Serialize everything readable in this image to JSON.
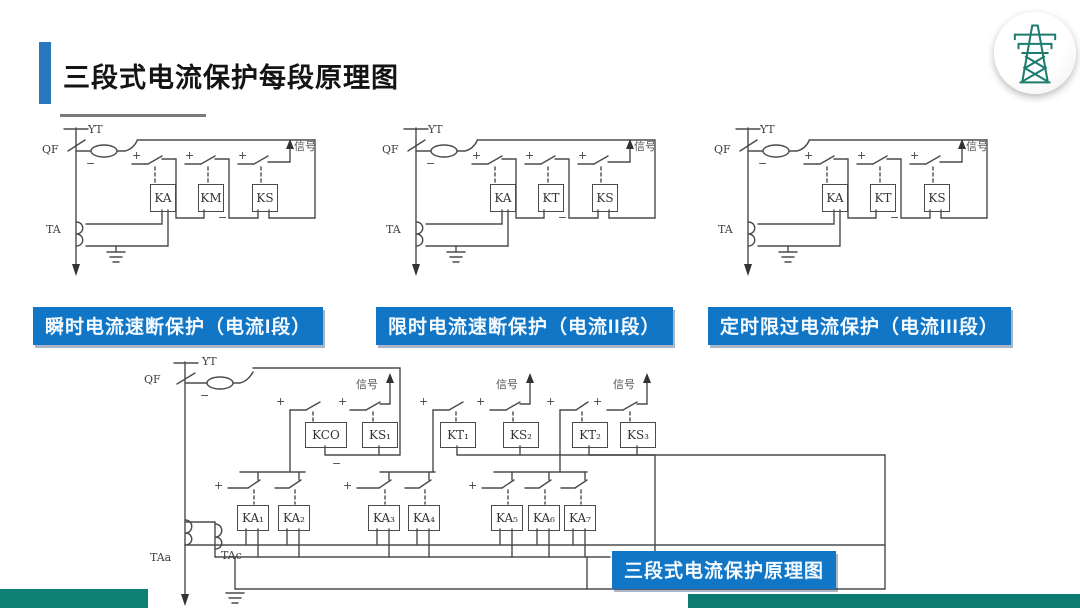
{
  "slide_title": "三段式电流保护每段原理图",
  "stage_diagrams": [
    {
      "caption": "瞬时电流速断保护（电流I段）",
      "labels": {
        "qf": "QF",
        "yt": "YT",
        "ta": "TA",
        "signal": "信号"
      },
      "relays": [
        "KA",
        "KM",
        "KS"
      ]
    },
    {
      "caption": "限时电流速断保护（电流II段）",
      "labels": {
        "qf": "QF",
        "yt": "YT",
        "ta": "TA",
        "signal": "信号"
      },
      "relays": [
        "KA",
        "KT",
        "KS"
      ]
    },
    {
      "caption": "定时限过电流保护（电流III段）",
      "labels": {
        "qf": "QF",
        "yt": "YT",
        "ta": "TA",
        "signal": "信号"
      },
      "relays": [
        "KA",
        "KT",
        "KS"
      ]
    }
  ],
  "combined_diagram": {
    "caption": "三段式电流保护原理图",
    "labels": {
      "qf": "QF",
      "yt": "YT",
      "taa": "TAa",
      "tac": "TAc",
      "signal": "信号"
    },
    "row1_relays": [
      "KCO",
      "KS₁",
      "KT₁",
      "KS₂",
      "KT₂",
      "KS₃"
    ],
    "row2_relays": [
      "KA₁",
      "KA₂",
      "KA₃",
      "KA₄",
      "KA₅",
      "KA₆",
      "KA₇"
    ]
  },
  "symbols": {
    "plus": "+",
    "minus": "−"
  },
  "colors": {
    "caption_blue": "#1176C6",
    "accent_bar_blue": "#2878BD",
    "teal_band": "#0E8076",
    "logo_teal": "#1C7B6F",
    "circuit_line": "#4B4B4B"
  }
}
